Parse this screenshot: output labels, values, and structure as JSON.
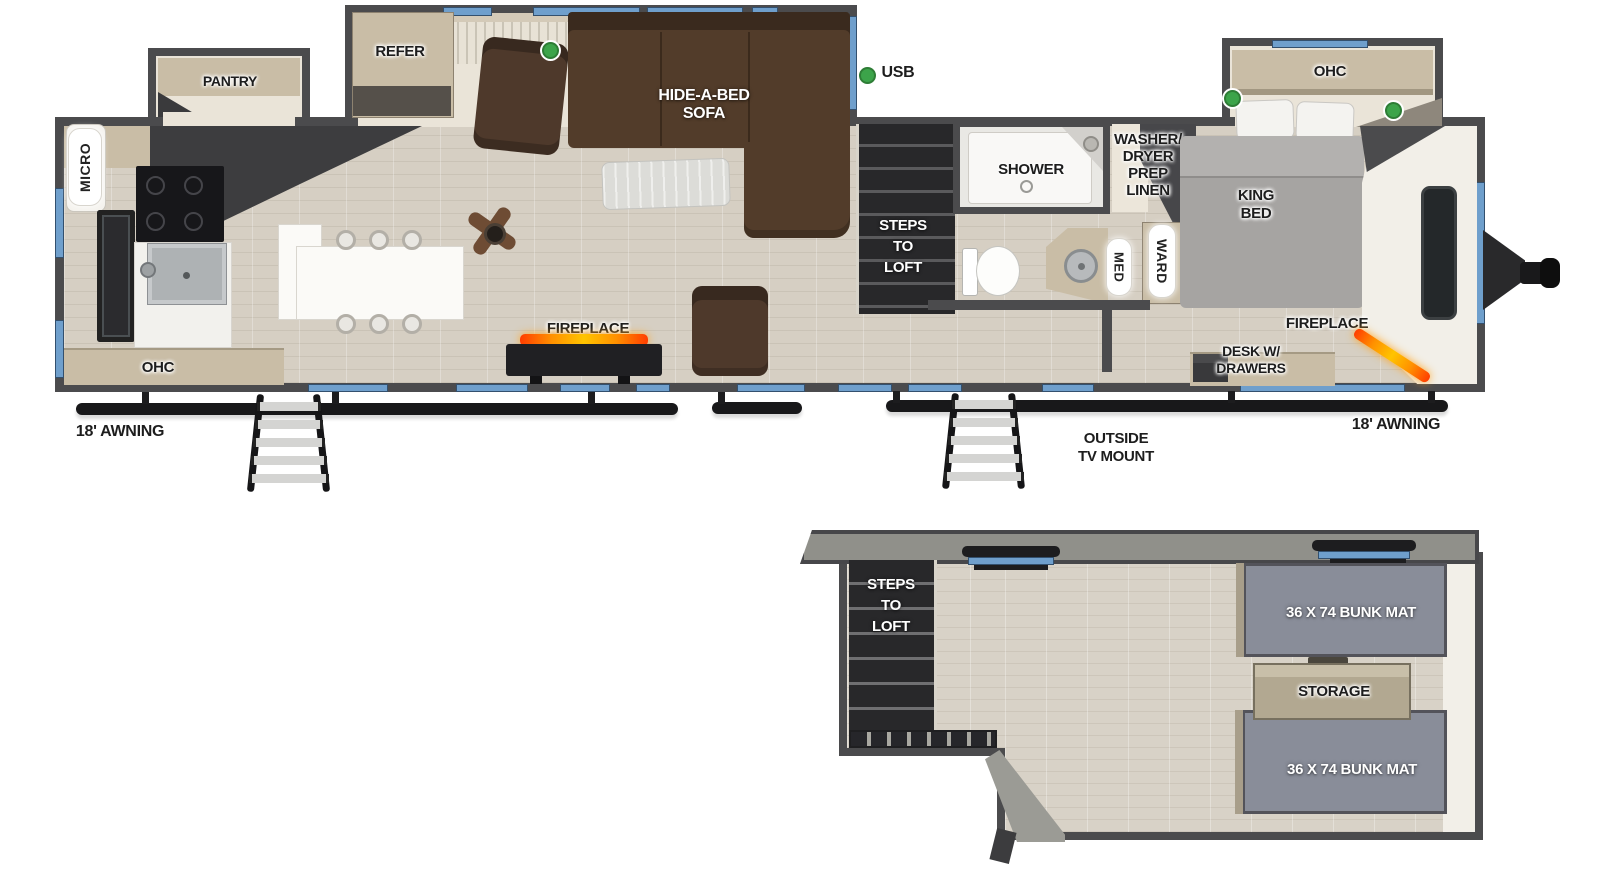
{
  "colors": {
    "wall": "#4b4b4d",
    "window_blue": "#6f9fcc",
    "usb_green": "#3ca44a",
    "floor_wood": "#d6cfc3",
    "slide_floor": "#eae4d8",
    "loft_floor": "#d8d2c7",
    "sofa_brown": "#523c2a",
    "chair_brown": "#4e392b",
    "cabinet_tan": "#c9bda6",
    "bunk_gray": "#898d99",
    "storage_tan": "#b2a891",
    "roof_gray": "#90908a",
    "flame": "#ff9100",
    "white_wall": "#f2efe8",
    "stairs_dark": "#28282a"
  },
  "labels": {
    "pantry": "PANTRY",
    "refer": "REFER",
    "hide_a_bed_1": "HIDE-A-BED",
    "hide_a_bed_2": "SOFA",
    "usb": "USB",
    "micro": "MICRO",
    "kitchen_ohc": "OHC",
    "fireplace_living": "FIREPLACE",
    "steps_main_1": "STEPS",
    "steps_main_2": "TO",
    "steps_main_3": "LOFT",
    "shower": "SHOWER",
    "wd_1": "WASHER/",
    "wd_2": "DRYER",
    "wd_3": "PREP",
    "wd_4": "LINEN",
    "med": "MED",
    "ward": "WARD",
    "king_1": "KING",
    "king_2": "BED",
    "bedroom_ohc": "OHC",
    "fireplace_bedroom": "FIREPLACE",
    "desk_1": "DESK W/",
    "desk_2": "DRAWERS",
    "awning_left": "18' AWNING",
    "awning_right": "18' AWNING",
    "outside_tv_1": "OUTSIDE",
    "outside_tv_2": "TV MOUNT",
    "loft_steps_1": "STEPS",
    "loft_steps_2": "TO",
    "loft_steps_3": "LOFT",
    "bunk_top": "36 X 74 BUNK MAT",
    "storage": "STORAGE",
    "bunk_bottom": "36 X 74 BUNK MAT"
  }
}
